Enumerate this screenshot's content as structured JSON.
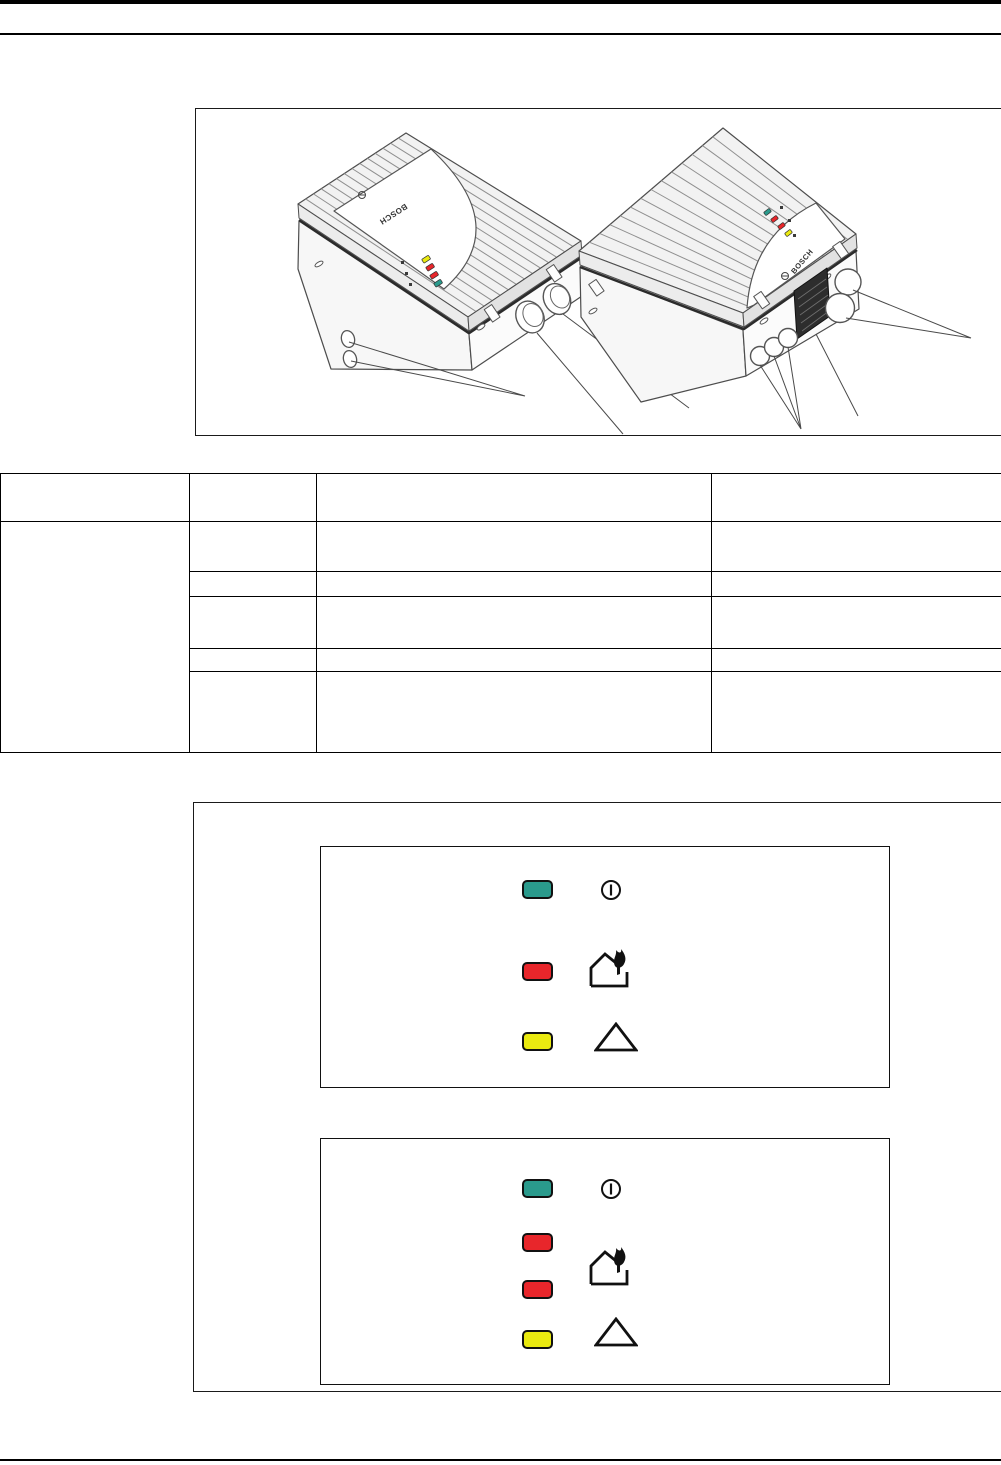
{
  "page": {
    "background": "#ffffff"
  },
  "figure_devices": {
    "left_device": {
      "brand": "BOSCH",
      "led_colors_top_to_bottom": [
        "yellow",
        "red",
        "red",
        "green"
      ],
      "led_hex": [
        "#eaea10",
        "#e8262b",
        "#e8262b",
        "#2a9a8c"
      ]
    },
    "right_device": {
      "brand": "BOSCH",
      "led_colors_top_to_bottom": [
        "green",
        "red",
        "red",
        "yellow"
      ],
      "led_hex": [
        "#2a9a8c",
        "#e8262b",
        "#e8262b",
        "#eaea10"
      ]
    }
  },
  "table": {
    "columns": 4,
    "header_rows": 1,
    "body_rows": 5,
    "cells_empty": true
  },
  "led_legend_box_1": {
    "rows": [
      {
        "led_color_name": "green",
        "led_color": "#2a9a8c",
        "icon": "power"
      },
      {
        "led_color_name": "red",
        "led_color": "#e8262b",
        "icon": "house-fire"
      },
      {
        "led_color_name": "yellow",
        "led_color": "#eaea10",
        "icon": "warning-triangle"
      }
    ]
  },
  "led_legend_box_2": {
    "rows": [
      {
        "led_color_name": "green",
        "led_color": "#2a9a8c",
        "icon": "power"
      },
      {
        "led_color_name": "red",
        "led_color": "#e8262b",
        "icon": "none"
      },
      {
        "led_color_name": "red",
        "led_color": "#e8262b",
        "icon": "house-fire"
      },
      {
        "led_color_name": "yellow",
        "led_color": "#eaea10",
        "icon": "warning-triangle"
      }
    ]
  }
}
